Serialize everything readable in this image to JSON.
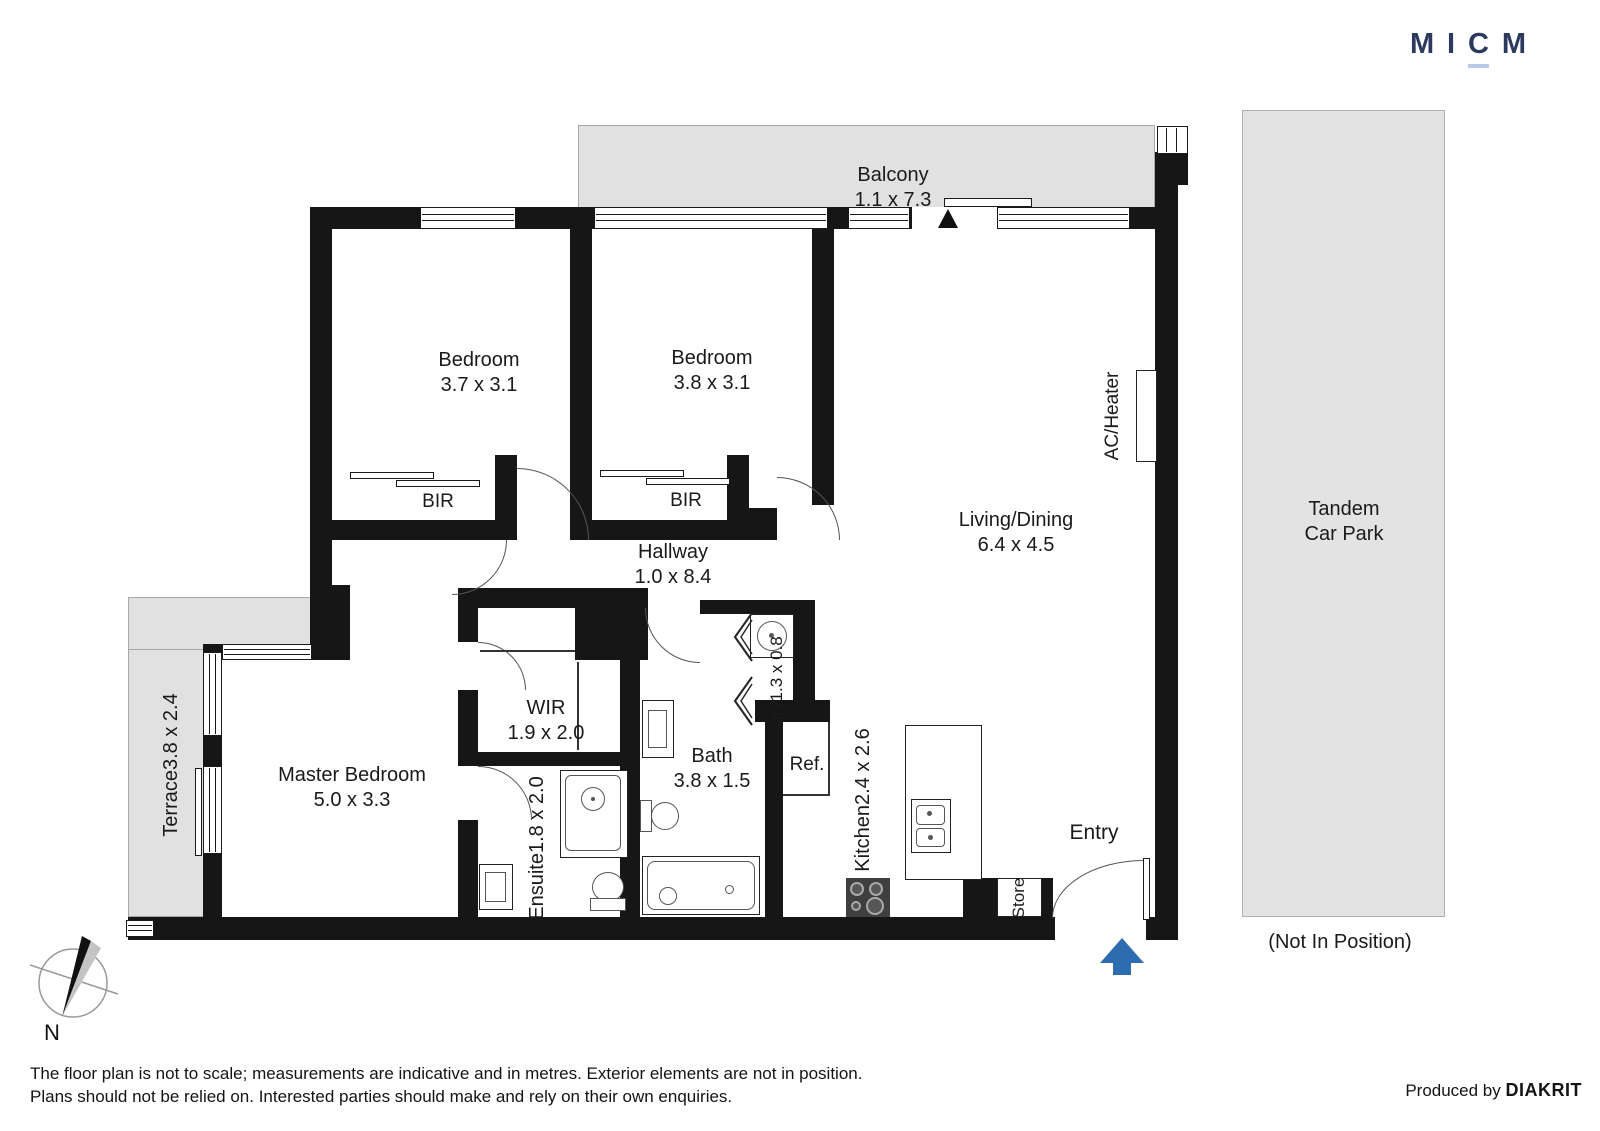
{
  "logo": {
    "l1": "M",
    "l2": "I",
    "l3": "C",
    "l4": "M"
  },
  "rooms": {
    "balcony": {
      "name": "Balcony",
      "dims": "1.1 x 7.3"
    },
    "bedroom1": {
      "name": "Bedroom",
      "dims": "3.7 x 3.1"
    },
    "bedroom2": {
      "name": "Bedroom",
      "dims": "3.8 x 3.1"
    },
    "living": {
      "name": "Living/Dining",
      "dims": "6.4 x 4.5"
    },
    "hallway": {
      "name": "Hallway",
      "dims": "1.0 x 8.4"
    },
    "master": {
      "name": "Master Bedroom",
      "dims": "5.0 x 3.3"
    },
    "wir": {
      "name": "WIR",
      "dims": "1.9 x 2.0"
    },
    "ensuite": {
      "name": "Ensuite",
      "dims": "1.8 x 2.0"
    },
    "bath": {
      "name": "Bath",
      "dims": "3.8 x 1.5"
    },
    "laundry": {
      "name": "L'dry",
      "dims": "1.3 x 0.8"
    },
    "kitchen": {
      "name": "Kitchen",
      "dims": "2.4 x 2.6"
    },
    "terrace": {
      "name": "Terrace",
      "dims": "3.8 x 2.4"
    },
    "bir1": {
      "name": "BIR"
    },
    "bir2": {
      "name": "BIR"
    },
    "fridge": {
      "name": "Ref."
    },
    "store": {
      "name": "Store"
    },
    "entry": {
      "name": "Entry"
    },
    "ac": {
      "line1": "AC/",
      "line2": "Heater"
    },
    "carpark": {
      "name": "Tandem",
      "name2": "Car Park",
      "note": "(Not In Position)"
    }
  },
  "compass": {
    "label": "N"
  },
  "footer": {
    "disclaimer_line1": "The floor plan is not to scale; measurements are indicative and in metres. Exterior elements are not in position.",
    "disclaimer_line2": "Plans should not be relied on. Interested parties should make and rely on their own enquiries.",
    "produced_by": "Produced by ",
    "producer": "DIAKRIT"
  },
  "colors": {
    "accent_blue": "#2e6cb0",
    "brand_navy": "#2b3a5e",
    "brand_underline": "#b9c9e8",
    "outdoor_fill": "#e1e1e1",
    "wall": "#161616"
  }
}
